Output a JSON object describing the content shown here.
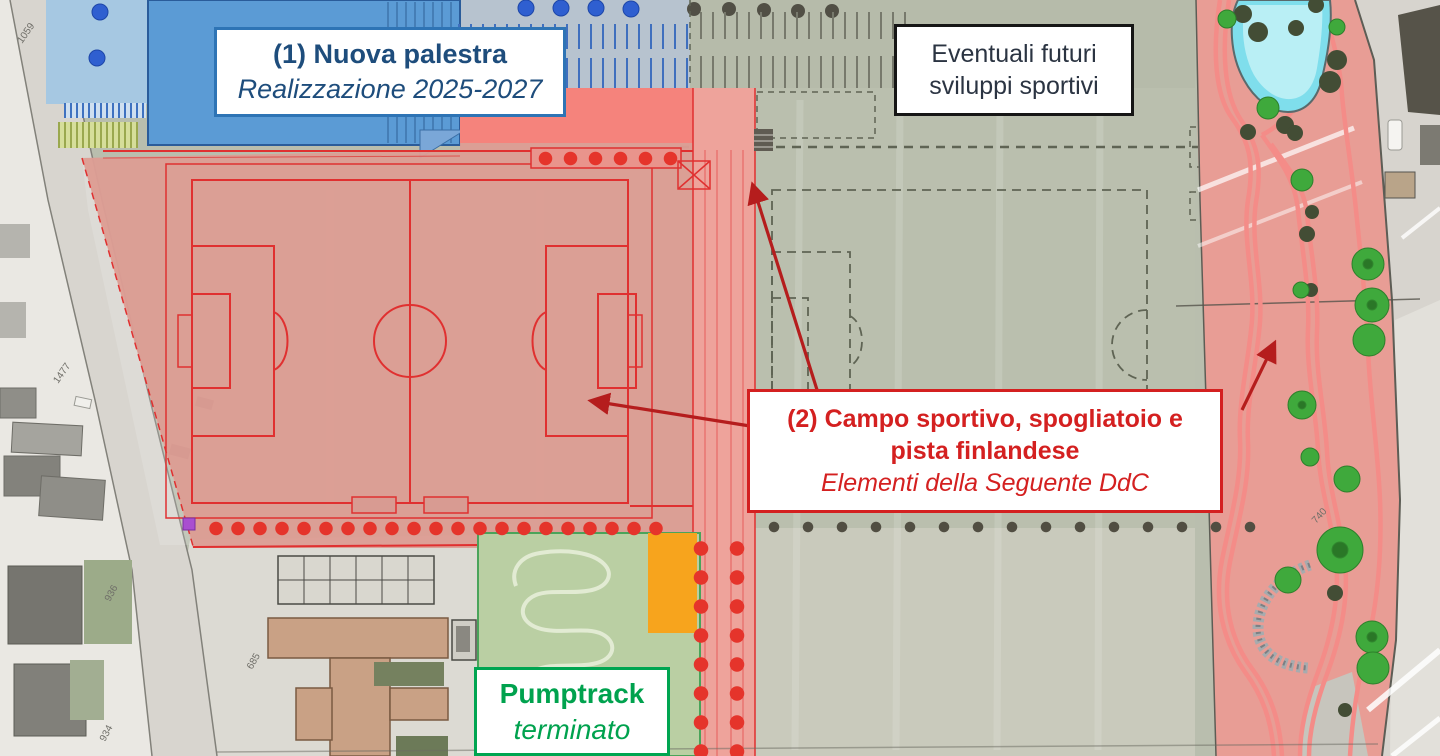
{
  "labels": {
    "palestra": {
      "title": "(1) Nuova palestra",
      "subtitle": "Realizzazione 2025-2027"
    },
    "sviluppi": {
      "line1": "Eventuali futuri",
      "line2": "sviluppi sportivi"
    },
    "campo": {
      "title_line1": "(2) Campo sportivo, spogliatoio e",
      "title_line2": "pista finlandese",
      "subtitle": "Elementi della Seguente DdC"
    },
    "pumptrack": {
      "title": "Pumptrack",
      "subtitle": "terminato"
    }
  },
  "parcels": [
    {
      "label": "1059"
    },
    {
      "label": "1477"
    },
    {
      "label": "936"
    },
    {
      "label": "934"
    },
    {
      "label": "685"
    },
    {
      "label": "740"
    }
  ],
  "colors": {
    "palestra_blue": "#5b9bd5",
    "label_blue_text": "#1e4d7c",
    "label_blue_border": "#2e74b5",
    "label_red": "#d42020",
    "label_green": "#00a551",
    "label_black": "#161616",
    "zone_red_overlay": "#dd9d94",
    "zone_red_bright": "#f5837c",
    "field_line_red": "#e03030",
    "arrow_red": "#b51d1d",
    "pumptrack_green": "#b9cfa3",
    "orange_area": "#f7a41d",
    "pool_cyan": "#7fdeec",
    "tree_green": "#3fa93c",
    "campus_gray_green": "#b9beae"
  }
}
